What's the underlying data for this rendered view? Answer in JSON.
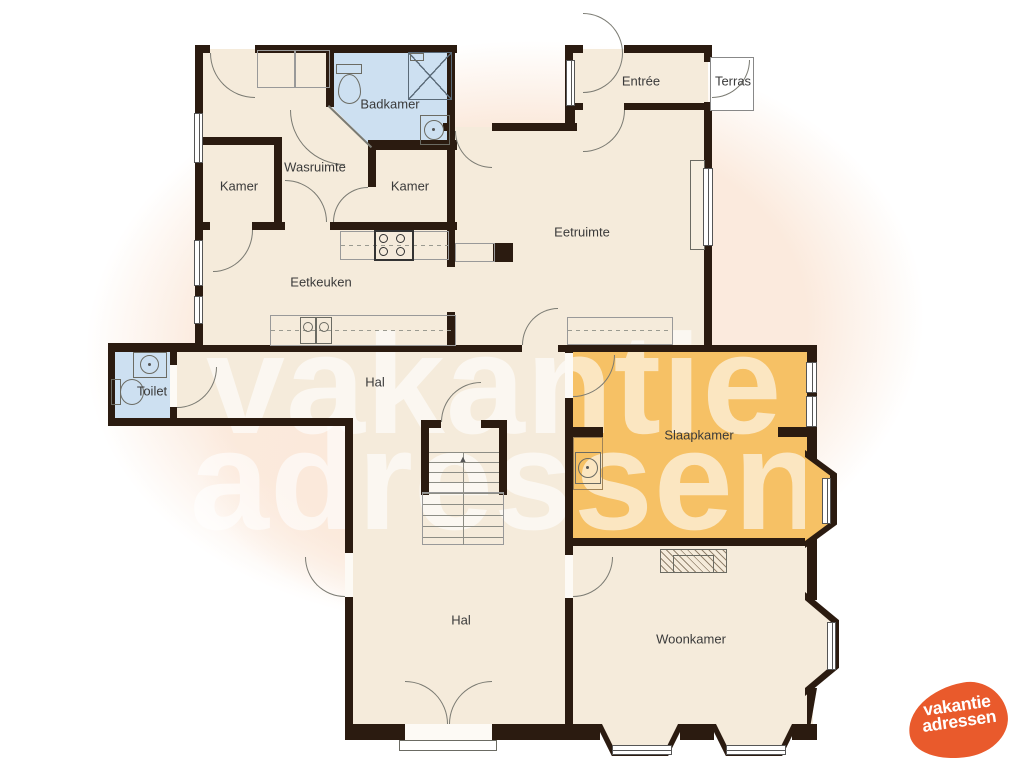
{
  "watermark": {
    "line1": "vakantie",
    "line2": "adressen"
  },
  "logo": {
    "line1": "vakantie",
    "line2": "adressen"
  },
  "rooms": {
    "badkamer": "Badkamer",
    "wasruimte": "Wasruimte",
    "kamer_left": "Kamer",
    "kamer_right": "Kamer",
    "entree": "Entrée",
    "terras": "Terras",
    "eetruimte": "Eetruimte",
    "eetkeuken": "Eetkeuken",
    "toilet": "Toilet",
    "hal_middle": "Hal",
    "slaapkamer": "Slaapkamer",
    "hal_lower": "Hal",
    "woonkamer": "Woonkamer"
  },
  "stairs": {
    "up_arrow": "▲"
  },
  "colors": {
    "wall": "#2b1b10",
    "floor": "#f5ebdb",
    "bathroom_floor": "#cde0f1",
    "bedroom_floor": "#f6c165",
    "background_blob": "#fbeadd",
    "logo_orange": "#e95a2c",
    "watermark": "rgba(255,255,255,0.6)"
  }
}
